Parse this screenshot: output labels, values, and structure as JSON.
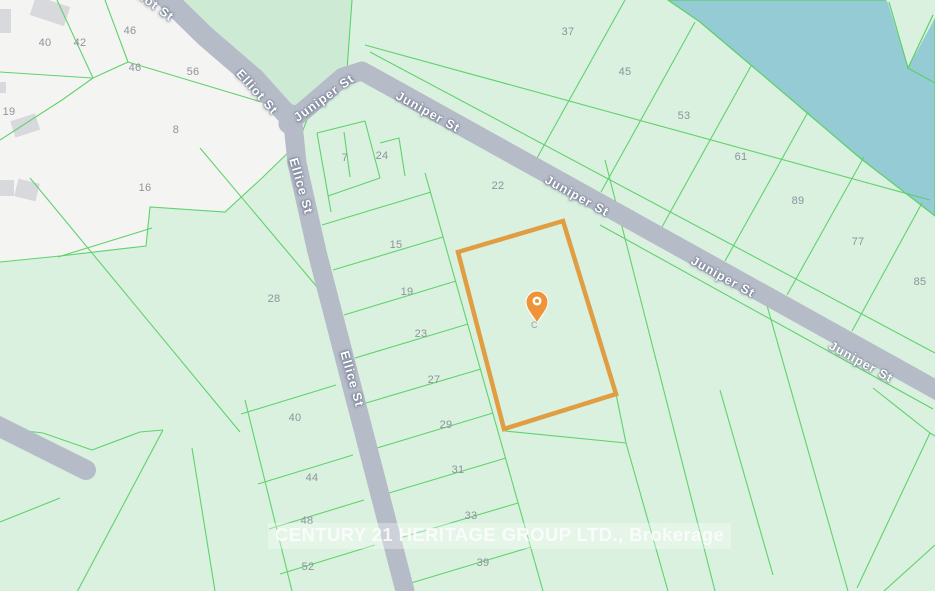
{
  "map": {
    "watermark": "CENTURY 21 HERITAGE GROUP LTD., Brokerage",
    "colors": {
      "land": "#d9f1de",
      "land_shaded": "#cdead5",
      "water": "#95cbd4",
      "parcel_line": "#5ad167",
      "road": "#b6bbc8",
      "built_area": "#f4f4f2",
      "building": "#d8d9dc",
      "selected_parcel_outline": "#e09d42",
      "marker": "#ee9338",
      "lot_text": "#8e939d"
    },
    "marker": {
      "label": "property-location",
      "sub_glyph": "C",
      "x": 537,
      "y": 306
    },
    "streets": [
      {
        "text": "Elliot St",
        "x": 150,
        "y": 2,
        "rot": 36
      },
      {
        "text": "Elliot St",
        "x": 257,
        "y": 92,
        "rot": 48
      },
      {
        "text": "Juniper St",
        "x": 324,
        "y": 98,
        "rot": -36
      },
      {
        "text": "Juniper St",
        "x": 428,
        "y": 112,
        "rot": 29
      },
      {
        "text": "Juniper St",
        "x": 577,
        "y": 196,
        "rot": 29
      },
      {
        "text": "Juniper St",
        "x": 723,
        "y": 277,
        "rot": 29
      },
      {
        "text": "Juniper St",
        "x": 861,
        "y": 362,
        "rot": 29
      },
      {
        "text": "Ellice St",
        "x": 301,
        "y": 186,
        "rot": 74
      },
      {
        "text": "Ellice St",
        "x": 352,
        "y": 379,
        "rot": 74
      }
    ],
    "lots": [
      {
        "n": "40",
        "x": 45,
        "y": 43
      },
      {
        "n": "42",
        "x": 80,
        "y": 43
      },
      {
        "n": "46",
        "x": 130,
        "y": 31
      },
      {
        "n": "46",
        "x": 135,
        "y": 68
      },
      {
        "n": "56",
        "x": 193,
        "y": 72
      },
      {
        "n": "19",
        "x": 9,
        "y": 112
      },
      {
        "n": "8",
        "x": 176,
        "y": 130
      },
      {
        "n": "16",
        "x": 145,
        "y": 188
      },
      {
        "n": "28",
        "x": 274,
        "y": 299
      },
      {
        "n": "7",
        "x": 345,
        "y": 158
      },
      {
        "n": "24",
        "x": 382,
        "y": 156
      },
      {
        "n": "22",
        "x": 498,
        "y": 186
      },
      {
        "n": "15",
        "x": 396,
        "y": 245
      },
      {
        "n": "19",
        "x": 407,
        "y": 292
      },
      {
        "n": "23",
        "x": 421,
        "y": 334
      },
      {
        "n": "27",
        "x": 434,
        "y": 380
      },
      {
        "n": "29",
        "x": 446,
        "y": 425
      },
      {
        "n": "31",
        "x": 458,
        "y": 470
      },
      {
        "n": "33",
        "x": 471,
        "y": 516
      },
      {
        "n": "39",
        "x": 483,
        "y": 563
      },
      {
        "n": "37",
        "x": 568,
        "y": 32
      },
      {
        "n": "45",
        "x": 625,
        "y": 72
      },
      {
        "n": "53",
        "x": 684,
        "y": 116
      },
      {
        "n": "61",
        "x": 741,
        "y": 157
      },
      {
        "n": "89",
        "x": 798,
        "y": 201
      },
      {
        "n": "77",
        "x": 858,
        "y": 242
      },
      {
        "n": "85",
        "x": 920,
        "y": 282
      },
      {
        "n": "40",
        "x": 295,
        "y": 418
      },
      {
        "n": "44",
        "x": 312,
        "y": 478
      },
      {
        "n": "48",
        "x": 307,
        "y": 521
      },
      {
        "n": "52",
        "x": 308,
        "y": 567
      }
    ]
  }
}
